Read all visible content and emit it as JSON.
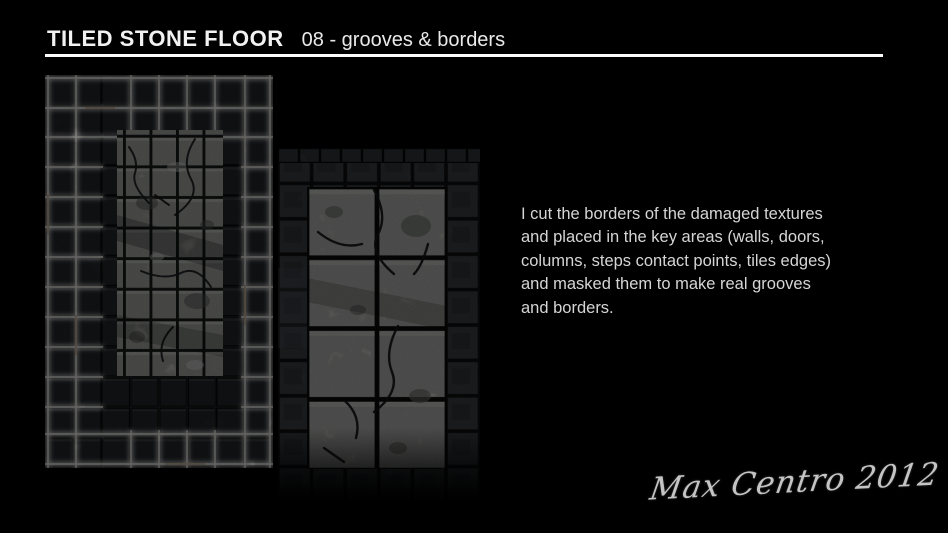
{
  "header": {
    "title": "TILED STONE FLOOR",
    "subtitle": "08 - grooves & borders"
  },
  "description": {
    "text": "I cut the borders of the damaged textures and placed in the key areas (walls, doors, columns, steps contact points, tiles edges) and masked them to make real grooves and borders.",
    "lines": [
      "I cut the borders of the damaged textures",
      "and placed in the key areas (walls, doors,",
      "columns, steps contact points, tiles edges)",
      "and masked them to make real grooves",
      "and borders."
    ]
  },
  "figures": {
    "left": {
      "alt": "tiled stone floor texture with bright glowing grooves and borders around dark and cracked marble tiles"
    },
    "right": {
      "alt": "tiled stone floor texture with large cracked marble tiles inside a dark stone tile border"
    }
  },
  "signature": {
    "text": "Max Centro 2012"
  },
  "colors": {
    "background": "#000000",
    "title_text": "#f2f2f2",
    "body_text": "#d5d5d5",
    "rule": "#fbfbfb",
    "marble_tile": "#a9aba7",
    "dark_tile": "#26292d",
    "glow": "#ffffff"
  }
}
